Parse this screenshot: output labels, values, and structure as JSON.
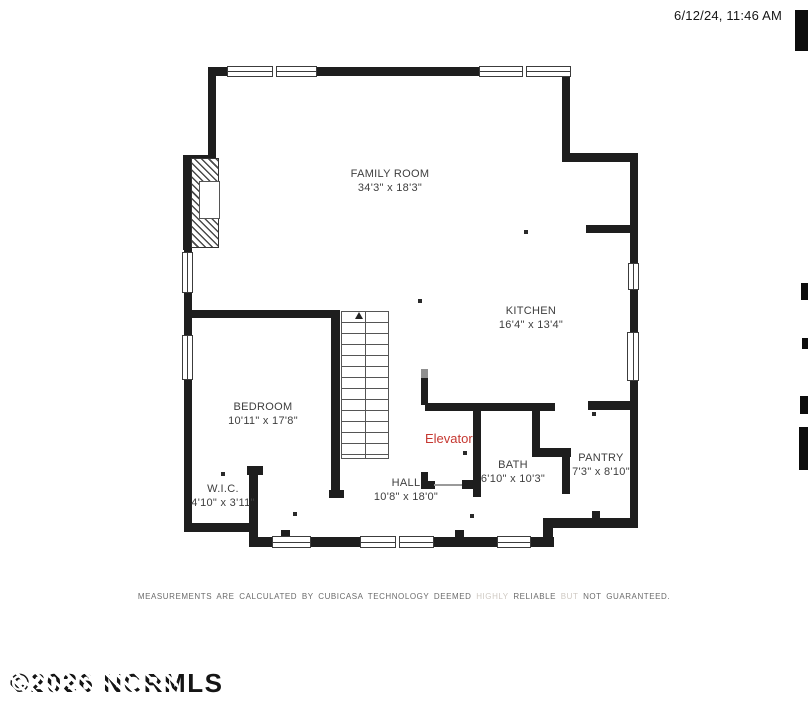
{
  "header": {
    "timestamp": "6/12/24, 11:46 AM"
  },
  "floorplan": {
    "rooms": [
      {
        "name": "FAMILY ROOM",
        "dims": "34'3\" x 18'3\""
      },
      {
        "name": "KITCHEN",
        "dims": "16'4\" x 13'4\""
      },
      {
        "name": "BEDROOM",
        "dims": "10'11\" x 17'8\""
      },
      {
        "name": "HALL",
        "dims": "10'8\" x 18'0\""
      },
      {
        "name": "BATH",
        "dims": "6'10\" x 10'3\""
      },
      {
        "name": "PANTRY",
        "dims": "7'3\" x 8'10\""
      },
      {
        "name": "W.I.C.",
        "dims": "4'10\" x 3'11\""
      }
    ],
    "elevator_label": "Elevator"
  },
  "footer": {
    "disclaimer_part1": "MEASUREMENTS ARE CALCULATED BY CUBICASA TECHNOLOGY DEEMED",
    "disclaimer_faded1": "HIGHLY",
    "disclaimer_part2": "RELIABLE",
    "disclaimer_faded2": "BUT",
    "disclaimer_part3": "NOT GUARANTEED.",
    "watermark": "©2026 NCRMLS"
  },
  "colors": {
    "wall": "#1e1e1e",
    "elevator_text": "#c63831",
    "label_text": "#3e3e3e"
  }
}
